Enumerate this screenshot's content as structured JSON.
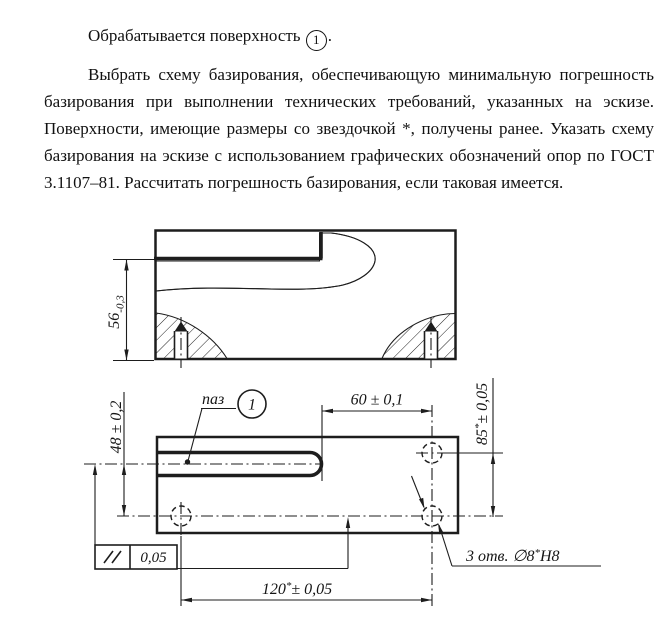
{
  "document": {
    "paragraph_intro": {
      "text": "Обрабатывается поверхность",
      "surface_marker": "1",
      "period": "."
    },
    "paragraph_task": "Выбрать схему базирования, обеспечивающую минимальную погрешность базирования при выполнении технических требований, указанных на эскизе. Поверхности, имеющие размеры со звездочкой *, получены ранее. Указать схему базирования на эскизе с использованием графических обозначений опор по ГОСТ 3.1107–81. Рассчитать погрешность базирования, если таковая имеется."
  },
  "drawing": {
    "front_view": {
      "height_dim": {
        "value": "56",
        "deviation": "-0,3"
      }
    },
    "plan_view": {
      "slot_label": "паз",
      "slot_balloon": "1",
      "dim_60": "60 ± 0,1",
      "dim_48": "48 ± 0,2",
      "dim_85": {
        "value": "85",
        "star": "*",
        "tolerance": "± 0,05"
      },
      "dim_120": {
        "value": "120",
        "star": "*",
        "tolerance": "± 0,05"
      },
      "parallelism_frame": {
        "symbol_name": "parallelism",
        "value": "0,05"
      },
      "holes_note": {
        "prefix": "3 отв. ∅8",
        "star": "*",
        "suffix": "H8"
      }
    },
    "colors": {
      "line": "#1d1d1d"
    }
  }
}
